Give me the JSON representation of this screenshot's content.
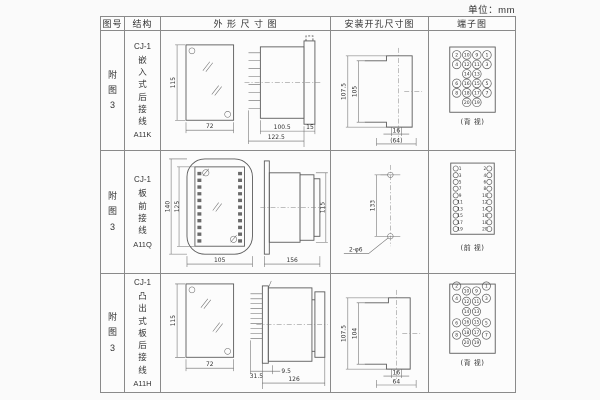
{
  "unit_label": "单位：mm",
  "colors": {
    "background": "#fafafa",
    "line": "#666666",
    "text": "#333333"
  },
  "headers": {
    "figure": "图号",
    "structure": "结构",
    "outline": "外 形 尺 寸 图",
    "install": "安装开孔尺寸图",
    "terminal": "端子图"
  },
  "rows": [
    {
      "figure_no": "附图3",
      "model": "CJ-1",
      "mount": "嵌入式后接线",
      "code": "A11K",
      "outline": {
        "front_h": "115",
        "front_w": "72",
        "body_len": "100.5",
        "total_len": "122.5",
        "flange": "15"
      },
      "install": {
        "outer_h": "107.5",
        "inner_h": "105",
        "notch_w": "16",
        "cutout_w": "(64)"
      },
      "terminal": {
        "caption": "(背 视)",
        "grid": [
          [
            2,
            10,
            9,
            1
          ],
          [
            4,
            12,
            11,
            3
          ],
          [
            null,
            14,
            13,
            null
          ],
          [
            6,
            16,
            15,
            5
          ],
          [
            8,
            18,
            17,
            7
          ],
          [
            null,
            20,
            19,
            null
          ]
        ]
      }
    },
    {
      "figure_no": "附图3",
      "model": "CJ-1",
      "mount": "板前接线",
      "code": "A11Q",
      "outline": {
        "outer_h": "140",
        "inner_h": "125",
        "front_w": "105",
        "total_len": "156",
        "body_h": "115"
      },
      "install": {
        "hole_spacing": "133",
        "holes": "2-φ6"
      },
      "terminal": {
        "caption": "(前 视)",
        "left": [
          1,
          3,
          5,
          7,
          9,
          11,
          13,
          15,
          17,
          19
        ],
        "right": [
          2,
          4,
          6,
          8,
          10,
          12,
          14,
          16,
          18,
          20
        ]
      }
    },
    {
      "figure_no": "附图3",
      "model": "CJ-1",
      "mount": "凸出式板后接线",
      "code": "A11H",
      "outline": {
        "front_h": "115",
        "front_w": "72",
        "base_len": "31.5",
        "panel_gap": "9.5",
        "body_len": "126"
      },
      "install": {
        "outer_h": "107.5",
        "inner_h": "104",
        "notch_w": "16",
        "cutout_w": "64"
      },
      "terminal": {
        "caption": "(背 视)",
        "grid": [
          [
            2,
            10,
            9,
            1
          ],
          [
            4,
            12,
            11,
            3
          ],
          [
            null,
            14,
            13,
            null
          ],
          [
            6,
            16,
            15,
            5
          ],
          [
            8,
            18,
            17,
            7
          ],
          [
            null,
            20,
            19,
            null
          ]
        ]
      }
    }
  ]
}
